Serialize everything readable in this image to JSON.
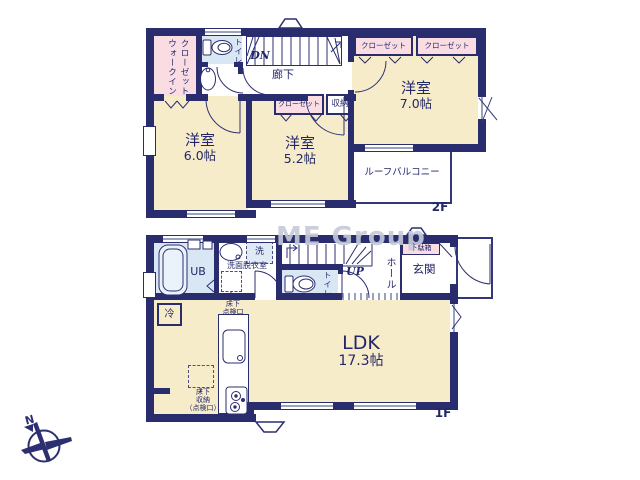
{
  "watermark": "ME Group",
  "compass": {
    "north_label": "N"
  },
  "colors": {
    "wall": "#292c6d",
    "room_fill": "#f7ecc9",
    "closet_fill": "#f9dde3",
    "wet_area_fill": "#d9e7f4",
    "window_line": "#9ba2bf",
    "watermark": "#c5cad8"
  },
  "floor2": {
    "label": "2F",
    "walk_in_closet_line1": "ウォークイン",
    "walk_in_closet_line2": "クローゼット",
    "toilet": "トイレ",
    "stairs_dn": "DN",
    "hallway": "廊下",
    "closet_top_left": "クローゼット",
    "closet_top_right": "クローゼット",
    "closet_mid": "クローゼット",
    "storage": "収納",
    "room_6": {
      "name": "洋室",
      "size": "6.0帖"
    },
    "room_52": {
      "name": "洋室",
      "size": "5.2帖"
    },
    "room_7": {
      "name": "洋室",
      "size": "7.0帖"
    },
    "roof_balcony": "ルーフバルコニー"
  },
  "floor1": {
    "label": "1F",
    "unit_bath": "UB",
    "washroom": "洗面脱衣室",
    "washer": "洗",
    "underfloor_access_line1": "床下",
    "underfloor_access_line2": "点検口",
    "toilet": "トイレ",
    "stairs_up": "UP",
    "hall": "ホール",
    "shoe_box": "下駄箱",
    "entrance": "玄関",
    "fridge": "冷",
    "ldk": {
      "name": "LDK",
      "size": "17.3帖"
    },
    "underfloor_storage_line1": "床下",
    "underfloor_storage_line2": "収納",
    "underfloor_storage_line3": "（点検口）"
  }
}
